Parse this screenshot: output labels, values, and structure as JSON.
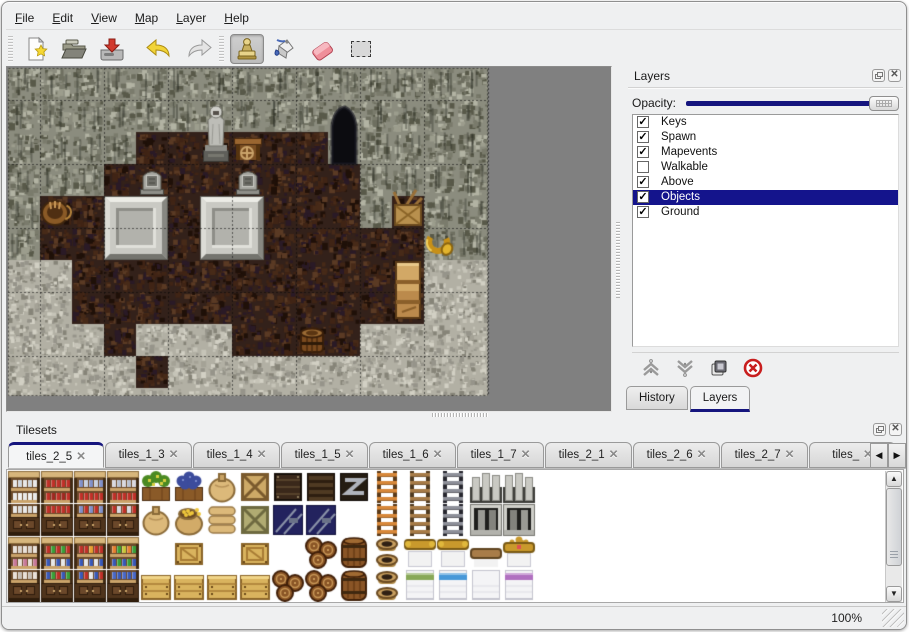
{
  "menu": {
    "items": [
      "File",
      "Edit",
      "View",
      "Map",
      "Layer",
      "Help"
    ]
  },
  "toolbar": {
    "buttons": [
      "new",
      "open",
      "save",
      "undo",
      "redo",
      "stamp",
      "fill",
      "eraser",
      "select"
    ],
    "selected_tool": "stamp"
  },
  "layers_panel": {
    "title": "Layers",
    "opacity_label": "Opacity:",
    "opacity_value": "100",
    "layers": [
      {
        "name": "Keys",
        "checked": true,
        "selected": false
      },
      {
        "name": "Spawn",
        "checked": true,
        "selected": false
      },
      {
        "name": "Mapevents",
        "checked": true,
        "selected": false
      },
      {
        "name": "Walkable",
        "checked": false,
        "selected": false
      },
      {
        "name": "Above",
        "checked": true,
        "selected": false
      },
      {
        "name": "Objects",
        "checked": true,
        "selected": true
      },
      {
        "name": "Ground",
        "checked": true,
        "selected": false
      }
    ],
    "action_buttons": [
      "raise-layer",
      "lower-layer",
      "duplicate-layer",
      "delete-layer"
    ],
    "tabs": [
      {
        "label": "History",
        "active": false
      },
      {
        "label": "Layers",
        "active": true
      }
    ]
  },
  "tilesets_panel": {
    "title": "Tilesets",
    "tabs": [
      {
        "label": "tiles_2_5",
        "active": true
      },
      {
        "label": "tiles_1_3",
        "active": false
      },
      {
        "label": "tiles_1_4",
        "active": false
      },
      {
        "label": "tiles_1_5",
        "active": false
      },
      {
        "label": "tiles_1_6",
        "active": false
      },
      {
        "label": "tiles_1_7",
        "active": false
      },
      {
        "label": "tiles_2_1",
        "active": false
      },
      {
        "label": "tiles_2_6",
        "active": false
      },
      {
        "label": "tiles_2_7",
        "active": false
      },
      {
        "label": "tiles_",
        "active": false
      }
    ]
  },
  "statusbar": {
    "zoom": "100%"
  },
  "colors": {
    "accent_navy": "#14148c",
    "window_bg": "#eff0f1",
    "map_void": "#808080",
    "wall_base": "#8b8c7e",
    "floor_base": "#33211a",
    "rubble_base": "#b2b0a4"
  },
  "map": {
    "tile_size": 32,
    "grid": [
      "WWWWWWWWWWWWWWW",
      "WWWWWWWWWWWWWWW",
      "WWWWFFFFFFWWWWW",
      "WWWFFFFFFFFWWWW",
      "WFFFFFFFFFFWFWW",
      "WFFFFFFFFFFFFWW",
      "RRFFFFFFFFFFFRR",
      "RRFFFFFFFFFFFRR",
      "RRRFRRRFFFFRRRR",
      "RRRRFRRRRRRRRRR",
      "RRRRRRRRRRRRRRR"
    ],
    "objects_under_grid": [
      {
        "t": "door",
        "c": 10,
        "r": 1
      },
      {
        "t": "platform",
        "c": 3,
        "r": 4
      },
      {
        "t": "platform",
        "c": 6,
        "r": 4
      }
    ],
    "objects_over_grid": [
      {
        "t": "statue",
        "c": 6,
        "r": 1
      },
      {
        "t": "table",
        "c": 7,
        "r": 2
      },
      {
        "t": "grave",
        "c": 4,
        "r": 3
      },
      {
        "t": "grave",
        "c": 7,
        "r": 3
      },
      {
        "t": "basket",
        "c": 1,
        "r": 4
      },
      {
        "t": "crates",
        "c": 12,
        "r": 4
      },
      {
        "t": "horn",
        "c": 13,
        "r": 5
      },
      {
        "t": "cabinet",
        "c": 12,
        "r": 6
      },
      {
        "t": "barrel",
        "c": 9,
        "r": 8
      }
    ]
  },
  "tileset": {
    "tile_pitch": 33,
    "grid": [
      [
        "shA_t",
        "shB_t",
        "shC_t",
        "shD_t",
        "plantCrate",
        "grapeCrate",
        "sack",
        "crateX",
        "darkCrate",
        "darkSlat",
        "metalZ",
        "ladderO",
        "ladderB",
        "ladderG",
        "archL",
        "archR"
      ],
      [
        "shA_b",
        "shB_b",
        "shC_b",
        "shD_b",
        "sack",
        "sackGold",
        "sackFlat",
        "crateX2",
        "navy",
        "navy",
        "",
        "ladderO",
        "ladderB",
        "ladderG",
        "nicheL",
        "nicheR"
      ],
      [
        "shE_t",
        "shF_t",
        "shG_t",
        "shH_t",
        "",
        "crateLid",
        "",
        "crateLid",
        "",
        "pile",
        "barrel",
        "pots",
        "bedHg",
        "bedHg",
        "bedHw",
        "bedHc"
      ],
      [
        "shE_b",
        "shF_b",
        "shG_b",
        "shH_b",
        "crate",
        "crate",
        "crate",
        "crate",
        "pile",
        "pile",
        "barrel",
        "pots",
        "bedFgreen",
        "bedFblue",
        "bedFwhite",
        "bedFpurple"
      ]
    ]
  }
}
